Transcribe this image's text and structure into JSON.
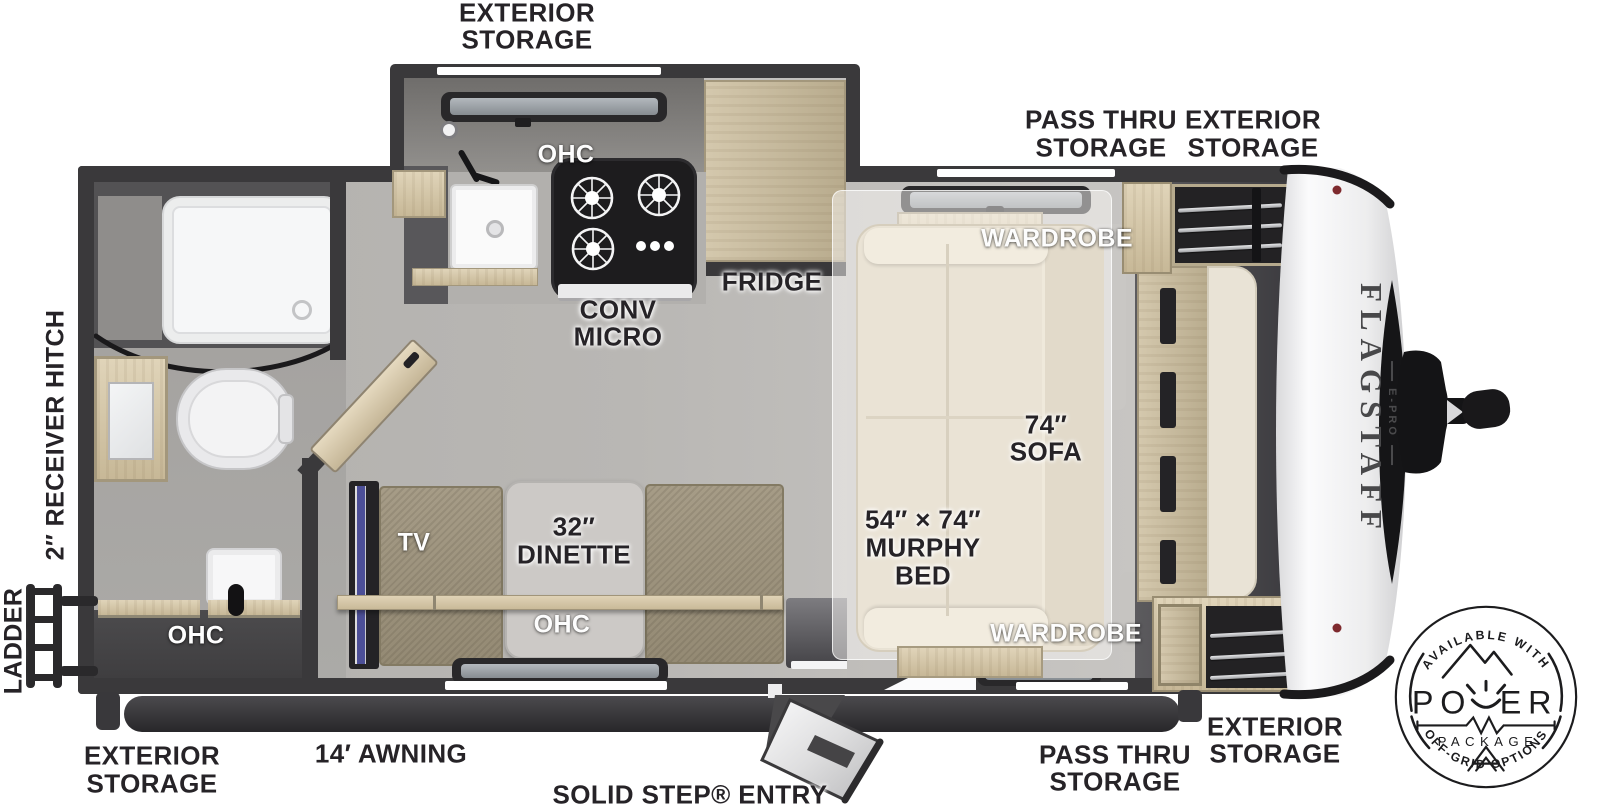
{
  "plan": {
    "callouts": {
      "exterior_storage_top": [
        "EXTERIOR",
        "STORAGE"
      ],
      "pass_thru_storage_top": [
        "PASS THRU",
        "STORAGE"
      ],
      "exterior_storage_top_right": [
        "EXTERIOR",
        "STORAGE"
      ],
      "ohc_kitchen": "OHC",
      "conv_micro": [
        "CONV",
        "MICRO"
      ],
      "fridge": "FRIDGE",
      "wardrobe_top": "WARDROBE",
      "sofa": [
        "74″",
        "SOFA"
      ],
      "murphy_bed": [
        "54″ × 74″",
        "MURPHY",
        "BED"
      ],
      "wardrobe_bottom": "WARDROBE",
      "dinette": [
        "32″",
        "DINETTE"
      ],
      "tv": "TV",
      "ohc_dinette": "OHC",
      "ohc_bath": "OHC",
      "receiver_hitch": "2″ RECEIVER HITCH",
      "ladder": "LADDER",
      "exterior_storage_bottom_left": [
        "EXTERIOR",
        "STORAGE"
      ],
      "awning": "14′ AWNING",
      "entry": "SOLID STEP® ENTRY",
      "pass_thru_storage_bottom": [
        "PASS THRU",
        "STORAGE"
      ],
      "exterior_storage_bottom_right": [
        "EXTERIOR",
        "STORAGE"
      ]
    },
    "brand": {
      "name": "FLAGSTAFF",
      "sub": "E-PRO"
    },
    "badge": {
      "top_arc": "AVAILABLE WITH",
      "word": "POWER",
      "word_parts": [
        "PO",
        "ER"
      ],
      "word_sub": "PACKAGE",
      "bottom_arc": "OFF-GRID OPTIONS"
    },
    "colors": {
      "wall": "#3a393b",
      "floor": "#b7b5b2",
      "wood": "#d5c8ad",
      "sofa_cream": "#eae3d5",
      "bench": "#a09681",
      "table": "#ccc9c6",
      "tv_accent_blue": "#4c4f97",
      "badge_ink": "#1c1c1e",
      "cap_white": "#f2f2f3",
      "marker_red": "#7e2a2e"
    }
  }
}
